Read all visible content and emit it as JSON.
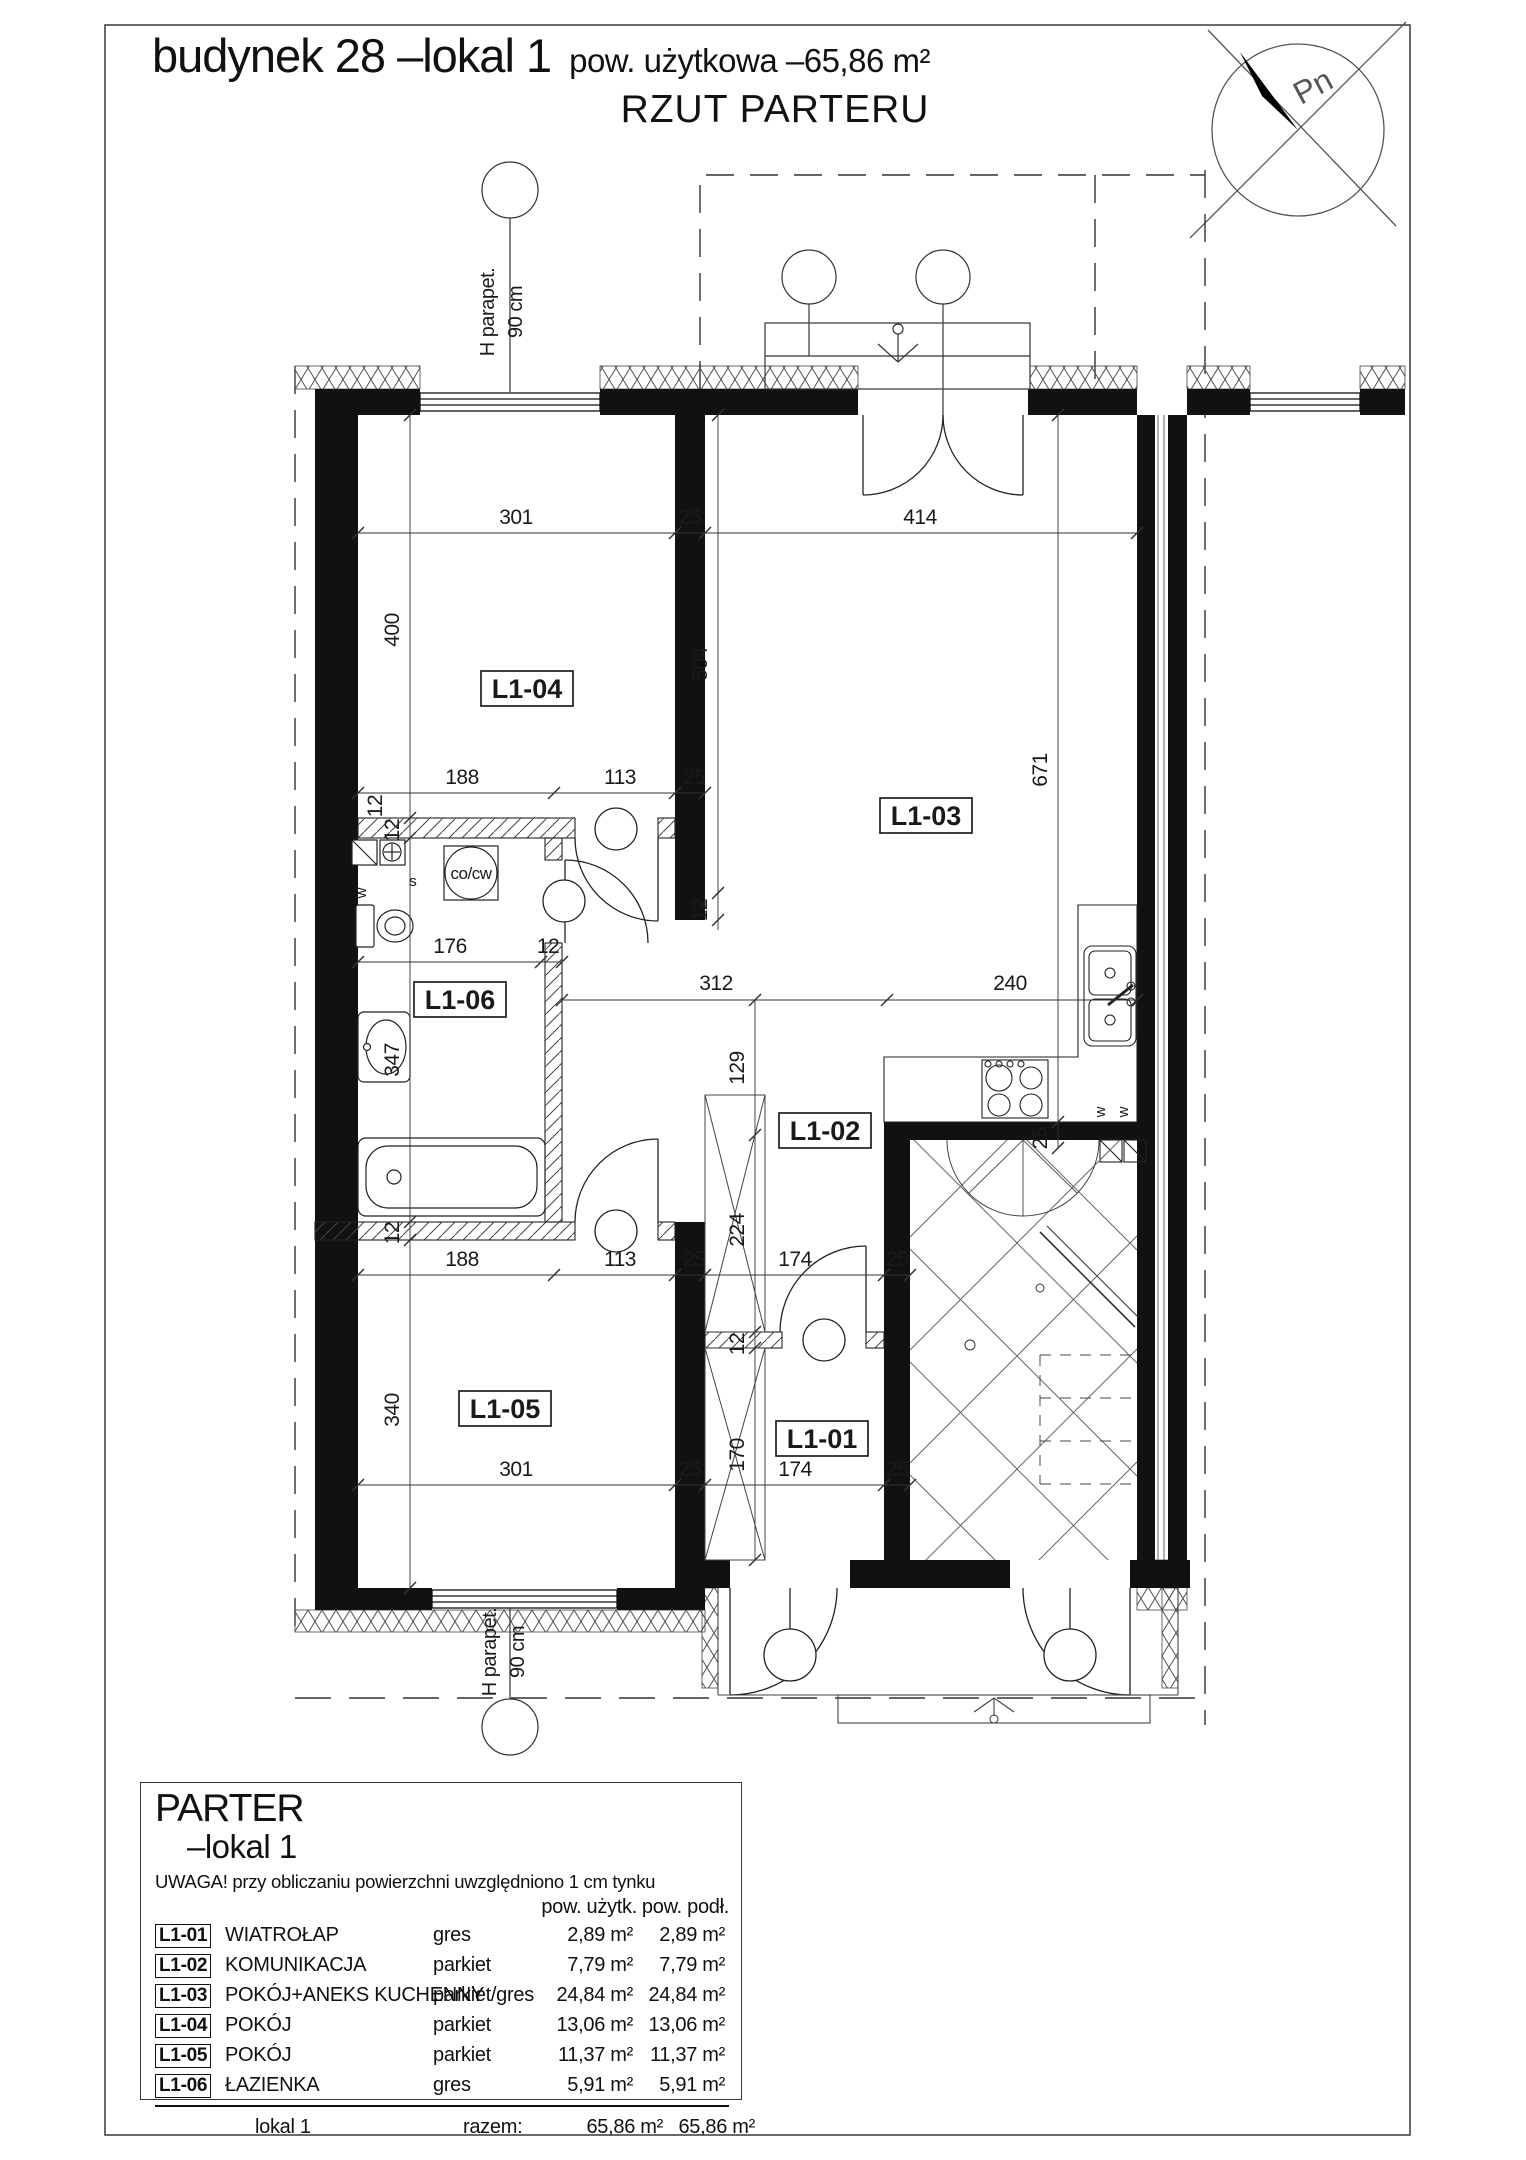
{
  "title": {
    "main": "budynek 28 –lokal 1",
    "area": "pow. użytkowa –65,86 m²",
    "subtitle": "RZUT PARTERU"
  },
  "compass": {
    "label": "Pn"
  },
  "plan": {
    "rooms": {
      "l101": "L1-01",
      "l102": "L1-02",
      "l103": "L1-03",
      "l104": "L1-04",
      "l105": "L1-05",
      "l106": "L1-06"
    },
    "dims": [
      "301",
      "25",
      "414",
      "188",
      "113",
      "25",
      "12",
      "176",
      "12",
      "312",
      "240",
      "400",
      "12",
      "347",
      "12",
      "340",
      "504",
      "12",
      "129",
      "224",
      "12",
      "170",
      "671",
      "25",
      "188",
      "113",
      "25",
      "174",
      "25",
      "301",
      "25",
      "174",
      "25"
    ],
    "annotations": {
      "parapet_top_a": "H parapet.",
      "parapet_top_b": "90 cm",
      "parapet_bottom_a": "H parapet.",
      "parapet_bottom_b": "90 cm",
      "boiler": "co/cw",
      "vent_w1": "w",
      "vent_s1": "s",
      "vent_w2": "w",
      "vent_w3": "w"
    }
  },
  "legend": {
    "title": "PARTER",
    "subtitle": "–lokal 1",
    "note": "UWAGA!  przy  obliczaniu  powierzchni  uwzględniono  1  cm  tynku",
    "col_uzytk": "pow. użytk.",
    "col_podl": "pow. podł.",
    "rows": [
      {
        "code": "L1-01",
        "name": "WIATROŁAP",
        "floor": "gres",
        "a1": "2,89 m²",
        "a2": "2,89 m²"
      },
      {
        "code": "L1-02",
        "name": "KOMUNIKACJA",
        "floor": "parkiet",
        "a1": "7,79 m²",
        "a2": "7,79 m²"
      },
      {
        "code": "L1-03",
        "name": "POKÓJ+ANEKS KUCHENNY",
        "floor": "parkiet/gres",
        "a1": "24,84 m²",
        "a2": "24,84 m²"
      },
      {
        "code": "L1-04",
        "name": "POKÓJ",
        "floor": "parkiet",
        "a1": "13,06 m²",
        "a2": "13,06 m²"
      },
      {
        "code": "L1-05",
        "name": "POKÓJ",
        "floor": "parkiet",
        "a1": "11,37 m²",
        "a2": "11,37 m²"
      },
      {
        "code": "L1-06",
        "name": "ŁAZIENKA",
        "floor": "gres",
        "a1": "5,91 m²",
        "a2": "5,91 m²"
      }
    ],
    "total": {
      "name": "lokal 1",
      "label": "razem:",
      "a1": "65,86 m²",
      "a2": "65,86 m²"
    }
  }
}
